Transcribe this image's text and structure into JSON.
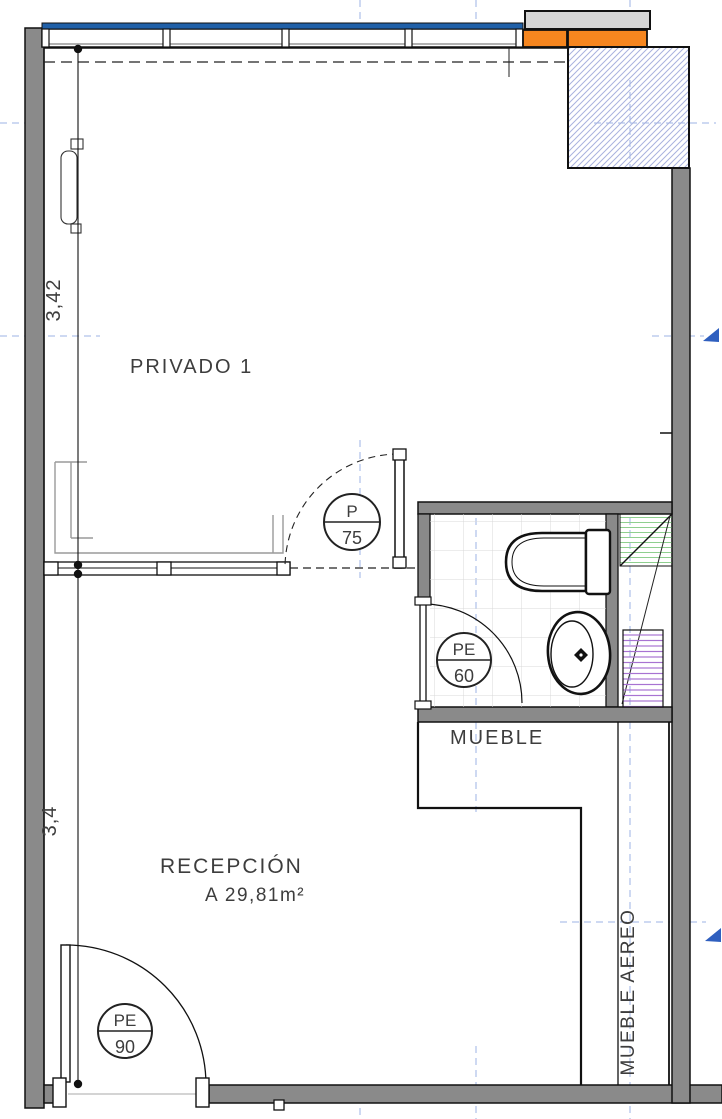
{
  "plan": {
    "title": "Floor plan – reception and private office",
    "rooms": {
      "privado": {
        "label": "PRIVADO 1"
      },
      "recepcion": {
        "label": "RECEPCIÓN",
        "area": "A 29,81m²"
      },
      "mueble": {
        "label": "MUEBLE"
      },
      "mueble_aereo": {
        "label": "MUEBLE AEREO"
      }
    },
    "dimensions": {
      "privado_depth": "3,42",
      "recepcion_depth": "3,4"
    },
    "door_tags": {
      "p75": {
        "top": "P",
        "bottom": "75"
      },
      "pe60": {
        "top": "PE",
        "bottom": "60"
      },
      "pe90": {
        "top": "PE",
        "bottom": "90"
      }
    },
    "colors": {
      "wall_gray": "#8a8a8a",
      "beam_gray": "#d5d5d5",
      "beam_orange": "#f6861f",
      "glazing_blue": "#2060a8",
      "hatch_blue": "#a9b2de",
      "grid_blue": "#9cb3e6",
      "arrow_blue": "#2f5fbf",
      "tile_gray": "#d9d9d9",
      "shelf_green": "#8fcf8f",
      "shelf_purple": "#a873d2",
      "furniture_gray": "#9a9a9a",
      "text_gray": "#3d3d3d"
    }
  }
}
